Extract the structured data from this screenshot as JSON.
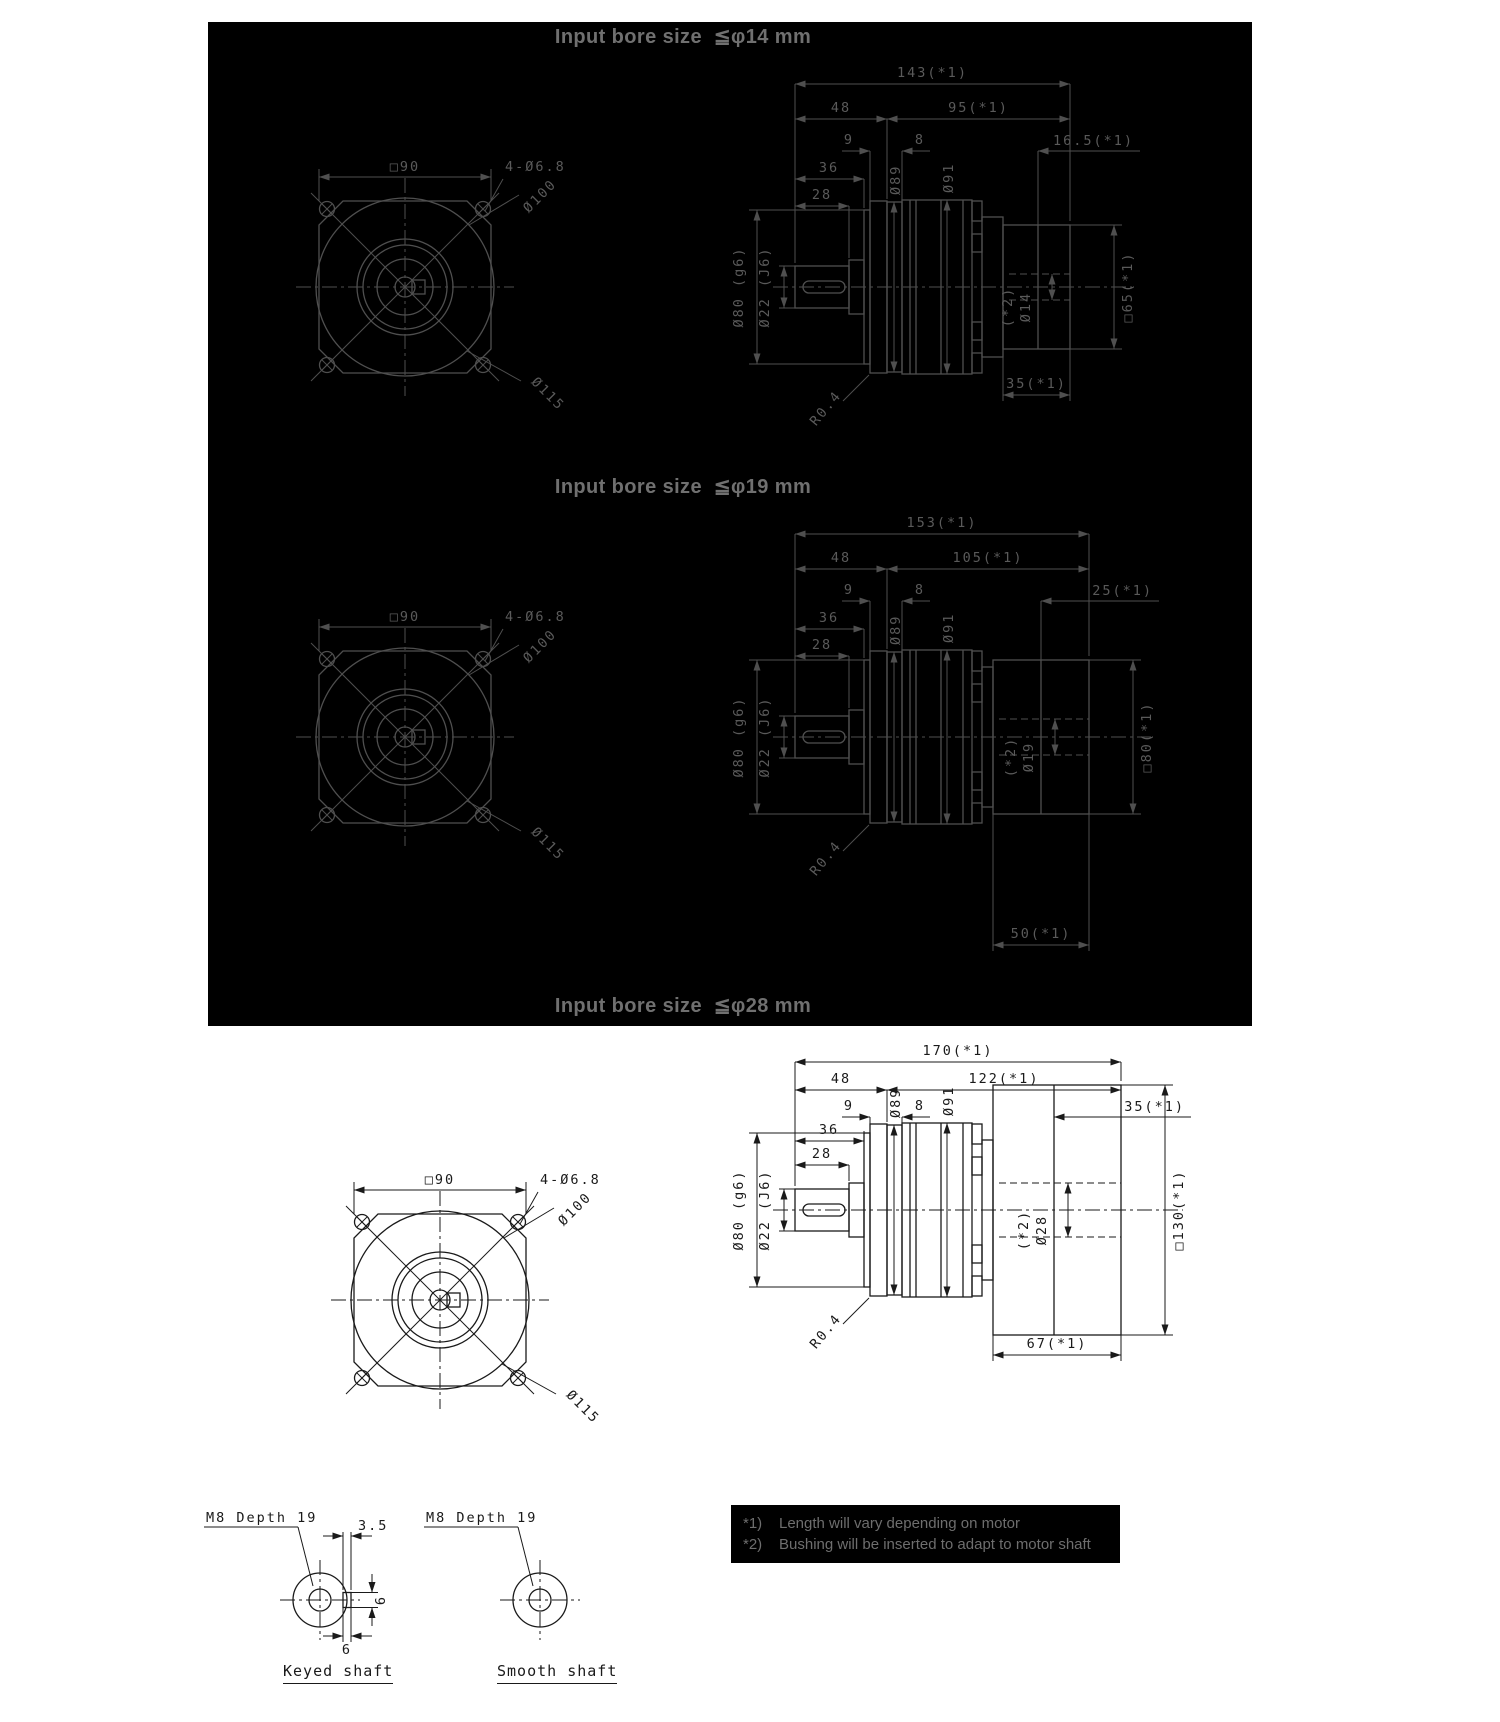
{
  "page": {
    "width": 1500,
    "height": 1722,
    "background": "#ffffff"
  },
  "colors": {
    "panel_bg": "#000000",
    "panel_line": "#4f4f4f",
    "panel_text": "#5a5a5a",
    "panel_title": "#707070",
    "ink": "#1a1a1a",
    "note_text": "#6e6e6e"
  },
  "sections": [
    {
      "title": "Input bore size  ≦φ14 mm",
      "front": {
        "square": "□90",
        "holes": "4-Ø6.8",
        "pilot": "Ø100",
        "bolt_circle": "Ø115"
      },
      "side": {
        "total": "143(*1)",
        "front_len": "48",
        "motor_len": "95(*1)",
        "flange_w": "9",
        "ring_w": "8",
        "tail": "16.5(*1)",
        "boss_len": "36",
        "shaft_len": "28",
        "dia89": "Ø89",
        "dia91": "Ø91",
        "dia80": "Ø80 (g6)",
        "dia22": "Ø22 (J6)",
        "bore_note": "(*2)",
        "bore": "Ø14",
        "motor_sq": "□65(*1)",
        "out_len": "35(*1)",
        "fillet": "R0.4"
      }
    },
    {
      "title": "Input bore size  ≦φ19 mm",
      "front": {
        "square": "□90",
        "holes": "4-Ø6.8",
        "pilot": "Ø100",
        "bolt_circle": "Ø115"
      },
      "side": {
        "total": "153(*1)",
        "front_len": "48",
        "motor_len": "105(*1)",
        "flange_w": "9",
        "ring_w": "8",
        "tail": "25(*1)",
        "boss_len": "36",
        "shaft_len": "28",
        "dia89": "Ø89",
        "dia91": "Ø91",
        "dia80": "Ø80 (g6)",
        "dia22": "Ø22 (J6)",
        "bore_note": "(*2)",
        "bore": "Ø19",
        "motor_sq": "□80(*1)",
        "out_len": "50(*1)",
        "fillet": "R0.4"
      }
    },
    {
      "title": "Input bore size  ≦φ28 mm",
      "front": {
        "square": "□90",
        "holes": "4-Ø6.8",
        "pilot": "Ø100",
        "bolt_circle": "Ø115"
      },
      "side": {
        "total": "170(*1)",
        "front_len": "48",
        "motor_len": "122(*1)",
        "flange_w": "9",
        "ring_w": "8",
        "tail": "35(*1)",
        "boss_len": "36",
        "shaft_len": "28",
        "dia89": "Ø89",
        "dia91": "Ø91",
        "dia80": "Ø80 (g6)",
        "dia22": "Ø22 (J6)",
        "bore_note": "(*2)",
        "bore": "Ø28",
        "motor_sq": "□130(*1)",
        "out_len": "67(*1)",
        "fillet": "R0.4"
      }
    }
  ],
  "shaft_details": {
    "keyed": {
      "thread": "M8 Depth 19",
      "top_dim": "3.5",
      "side_dim": "6",
      "bottom_dim": "6",
      "label": "Keyed shaft"
    },
    "smooth": {
      "thread": "M8 Depth 19",
      "label": "Smooth shaft"
    }
  },
  "notes": [
    {
      "ref": "*1)",
      "text": "Length will vary depending on motor"
    },
    {
      "ref": "*2)",
      "text": "Bushing will be inserted to adapt to motor shaft"
    }
  ]
}
